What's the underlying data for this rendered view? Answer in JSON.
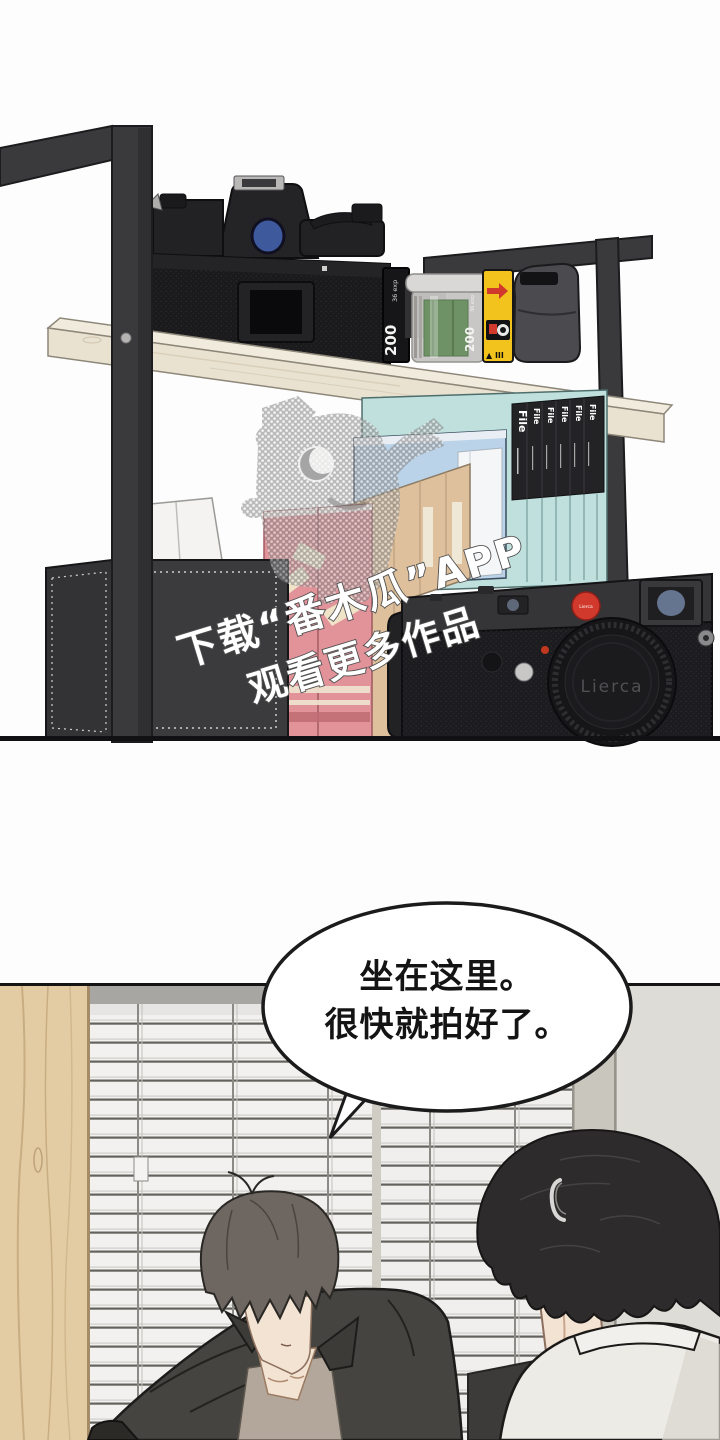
{
  "watermark": {
    "line1": "下载“番木瓜”APP",
    "line2": "观看更多作品"
  },
  "panel1": {
    "film_box": {
      "speed": "200",
      "exposures": "36 exp"
    },
    "film_canister": {
      "speed": "200",
      "exposures": "36 exp"
    },
    "disposable_camera": {
      "speed_mark": "▲ III"
    },
    "file_boxes": {
      "label": "File"
    },
    "lierca": {
      "brand": "Lierca",
      "logo_text": "Lierca"
    }
  },
  "panel2": {
    "bubble_line1": "坐在这里。",
    "bubble_line2": "很快就拍好了。"
  },
  "colors": {
    "red": "#d0392b",
    "yellow": "#f2c31c",
    "teal": "#bfe0dd",
    "blue": "#bad3e8",
    "pink": "#e2939a",
    "tan": "#dec09c",
    "wood_shelf": "#eae2d1",
    "wood_plank": "#e3cca4",
    "skin": "#f2e3d3",
    "hair_gray": "#6e6660",
    "hair_black": "#2e2b2c",
    "shirt_white": "#edebe6",
    "jacket": "#454440",
    "frame": "#3a393c"
  }
}
